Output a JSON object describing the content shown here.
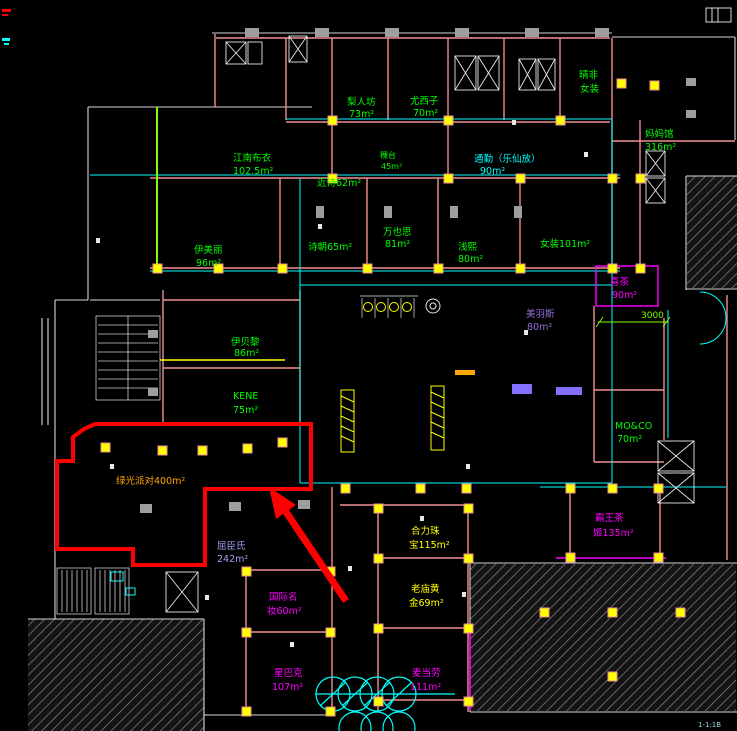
{
  "colors": {
    "highlight_red": "#ff0000",
    "wall_pink": "#ef8f8f",
    "line_cyan": "#00ffff",
    "line_green": "#00ff00",
    "line_chartreuse": "#7fff00",
    "line_yellow": "#ffff00",
    "line_magenta": "#ff00ff",
    "label_purple": "#9370db",
    "label_lavender": "#9f9fef",
    "label_orange": "#ffa500",
    "wall_white": "#d8d8d8",
    "column_gray": "#9e9e9e"
  },
  "plan": {
    "labels": [
      {
        "line1": "梨人坊",
        "line2": "73m²",
        "color": "#00ff00"
      },
      {
        "line1": "尤西子",
        "line2": "70m²",
        "color": "#00ff00"
      },
      {
        "line1": "通勤（乐仙放）",
        "line2": "90m²",
        "color": "#00ffff"
      },
      {
        "line1": "晴非",
        "line2": "女装",
        "color": "#00ff00"
      },
      {
        "line1": "妈妈馆",
        "line2": "316m²",
        "color": "#00ff00"
      },
      {
        "line1": "江南布衣",
        "line2": "102.5m²",
        "color": "#00ff00"
      },
      {
        "line1": "近诗62m²",
        "line2": "",
        "color": "#00ff00"
      },
      {
        "line1": "稞台",
        "line2": "45m²",
        "color": "#00ff00"
      },
      {
        "line1": "伊美丽",
        "line2": "96m²",
        "color": "#00ff00"
      },
      {
        "line1": "诗朝65m²",
        "line2": "",
        "color": "#00ff00"
      },
      {
        "line1": "万也思",
        "line2": "81m²",
        "color": "#00ff00"
      },
      {
        "line1": "浅熙",
        "line2": "80m²",
        "color": "#00ff00"
      },
      {
        "line1": "女装101m²",
        "line2": "",
        "color": "#00ff00"
      },
      {
        "line1": "喜茶",
        "line2": "90m²",
        "color": "#ff00ff"
      },
      {
        "line1": "美羽斯",
        "line2": "80m²",
        "color": "#9370db"
      },
      {
        "line1": "伊贝黎",
        "line2": "86m²",
        "color": "#00ff00"
      },
      {
        "line1": "KENE",
        "line2": "75m²",
        "color": "#00ff00"
      },
      {
        "line1": "MO&CO",
        "line2": "70m²",
        "color": "#00ff00"
      },
      {
        "line1": "绿光派对400m²",
        "line2": "",
        "color": "#ffa500"
      },
      {
        "line1": "屈臣氏",
        "line2": "242m²",
        "color": "#9f9fef"
      },
      {
        "line1": "合力珠",
        "line2": "宝115m²",
        "color": "#ffff00"
      },
      {
        "line1": "老庙黄",
        "line2": "金69m²",
        "color": "#ffff00"
      },
      {
        "line1": "国际名",
        "line2": "妆60m²",
        "color": "#ff00ff"
      },
      {
        "line1": "星巴克",
        "line2": "107m²",
        "color": "#ff00ff"
      },
      {
        "line1": "麦当劳",
        "line2": "111m²",
        "color": "#ff00ff"
      },
      {
        "line1": "霸王茶",
        "line2": "姬135m²",
        "color": "#ff00ff"
      }
    ],
    "dimension_3000": "3000",
    "corner_note": "1-1:1B"
  }
}
